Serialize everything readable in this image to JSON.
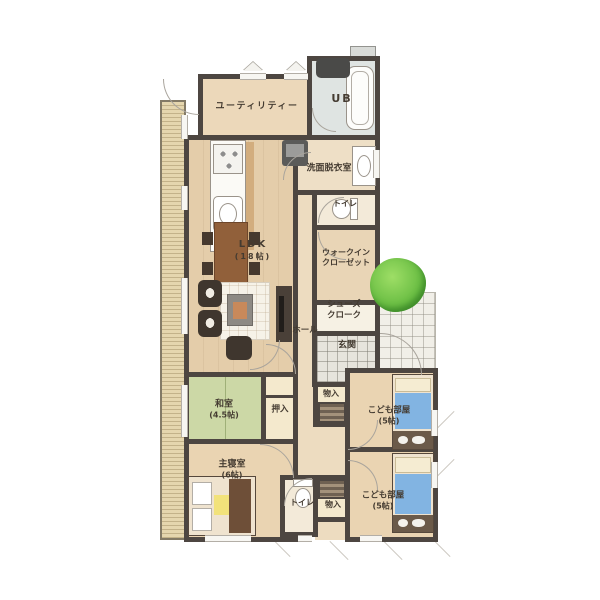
{
  "plan": {
    "rooms": {
      "utility": {
        "label": "ユーティリティー"
      },
      "ub": {
        "label": "UB"
      },
      "senmen": {
        "label": "洗面脱衣室"
      },
      "toilet_upper": {
        "label": "トイレ"
      },
      "wic": {
        "line1": "ウォークイン",
        "line2": "クローゼット"
      },
      "shoes": {
        "line1": "シューズ",
        "line2": "クローク"
      },
      "genkan": {
        "label": "玄関"
      },
      "hall": {
        "label": "ホール"
      },
      "ldk": {
        "label": "LDK",
        "size": "(18帖)"
      },
      "washitsu": {
        "label": "和室",
        "size": "(4.5帖)"
      },
      "oshiire": {
        "label": "押入"
      },
      "storage_upper": {
        "label": "物入"
      },
      "kids_upper": {
        "label": "こども部屋",
        "size": "(5帖)"
      },
      "master": {
        "label": "主寝室",
        "size": "(6帖)"
      },
      "toilet_lower": {
        "label": "トイレ"
      },
      "storage_lower": {
        "label": "物入"
      },
      "kids_lower": {
        "label": "こども部屋",
        "size": "(5帖)"
      }
    },
    "palette": {
      "wall": "#4d4641",
      "floor": "#ead4b2",
      "tatami": "#ccd8a6",
      "closet": "#f4e9cd",
      "bed_blue": "#82b4e2",
      "tree_green": "#5cb53a",
      "deck": "#e0d0a8",
      "tile": "#e7e4dc",
      "bath": "#dfe4e2"
    }
  }
}
